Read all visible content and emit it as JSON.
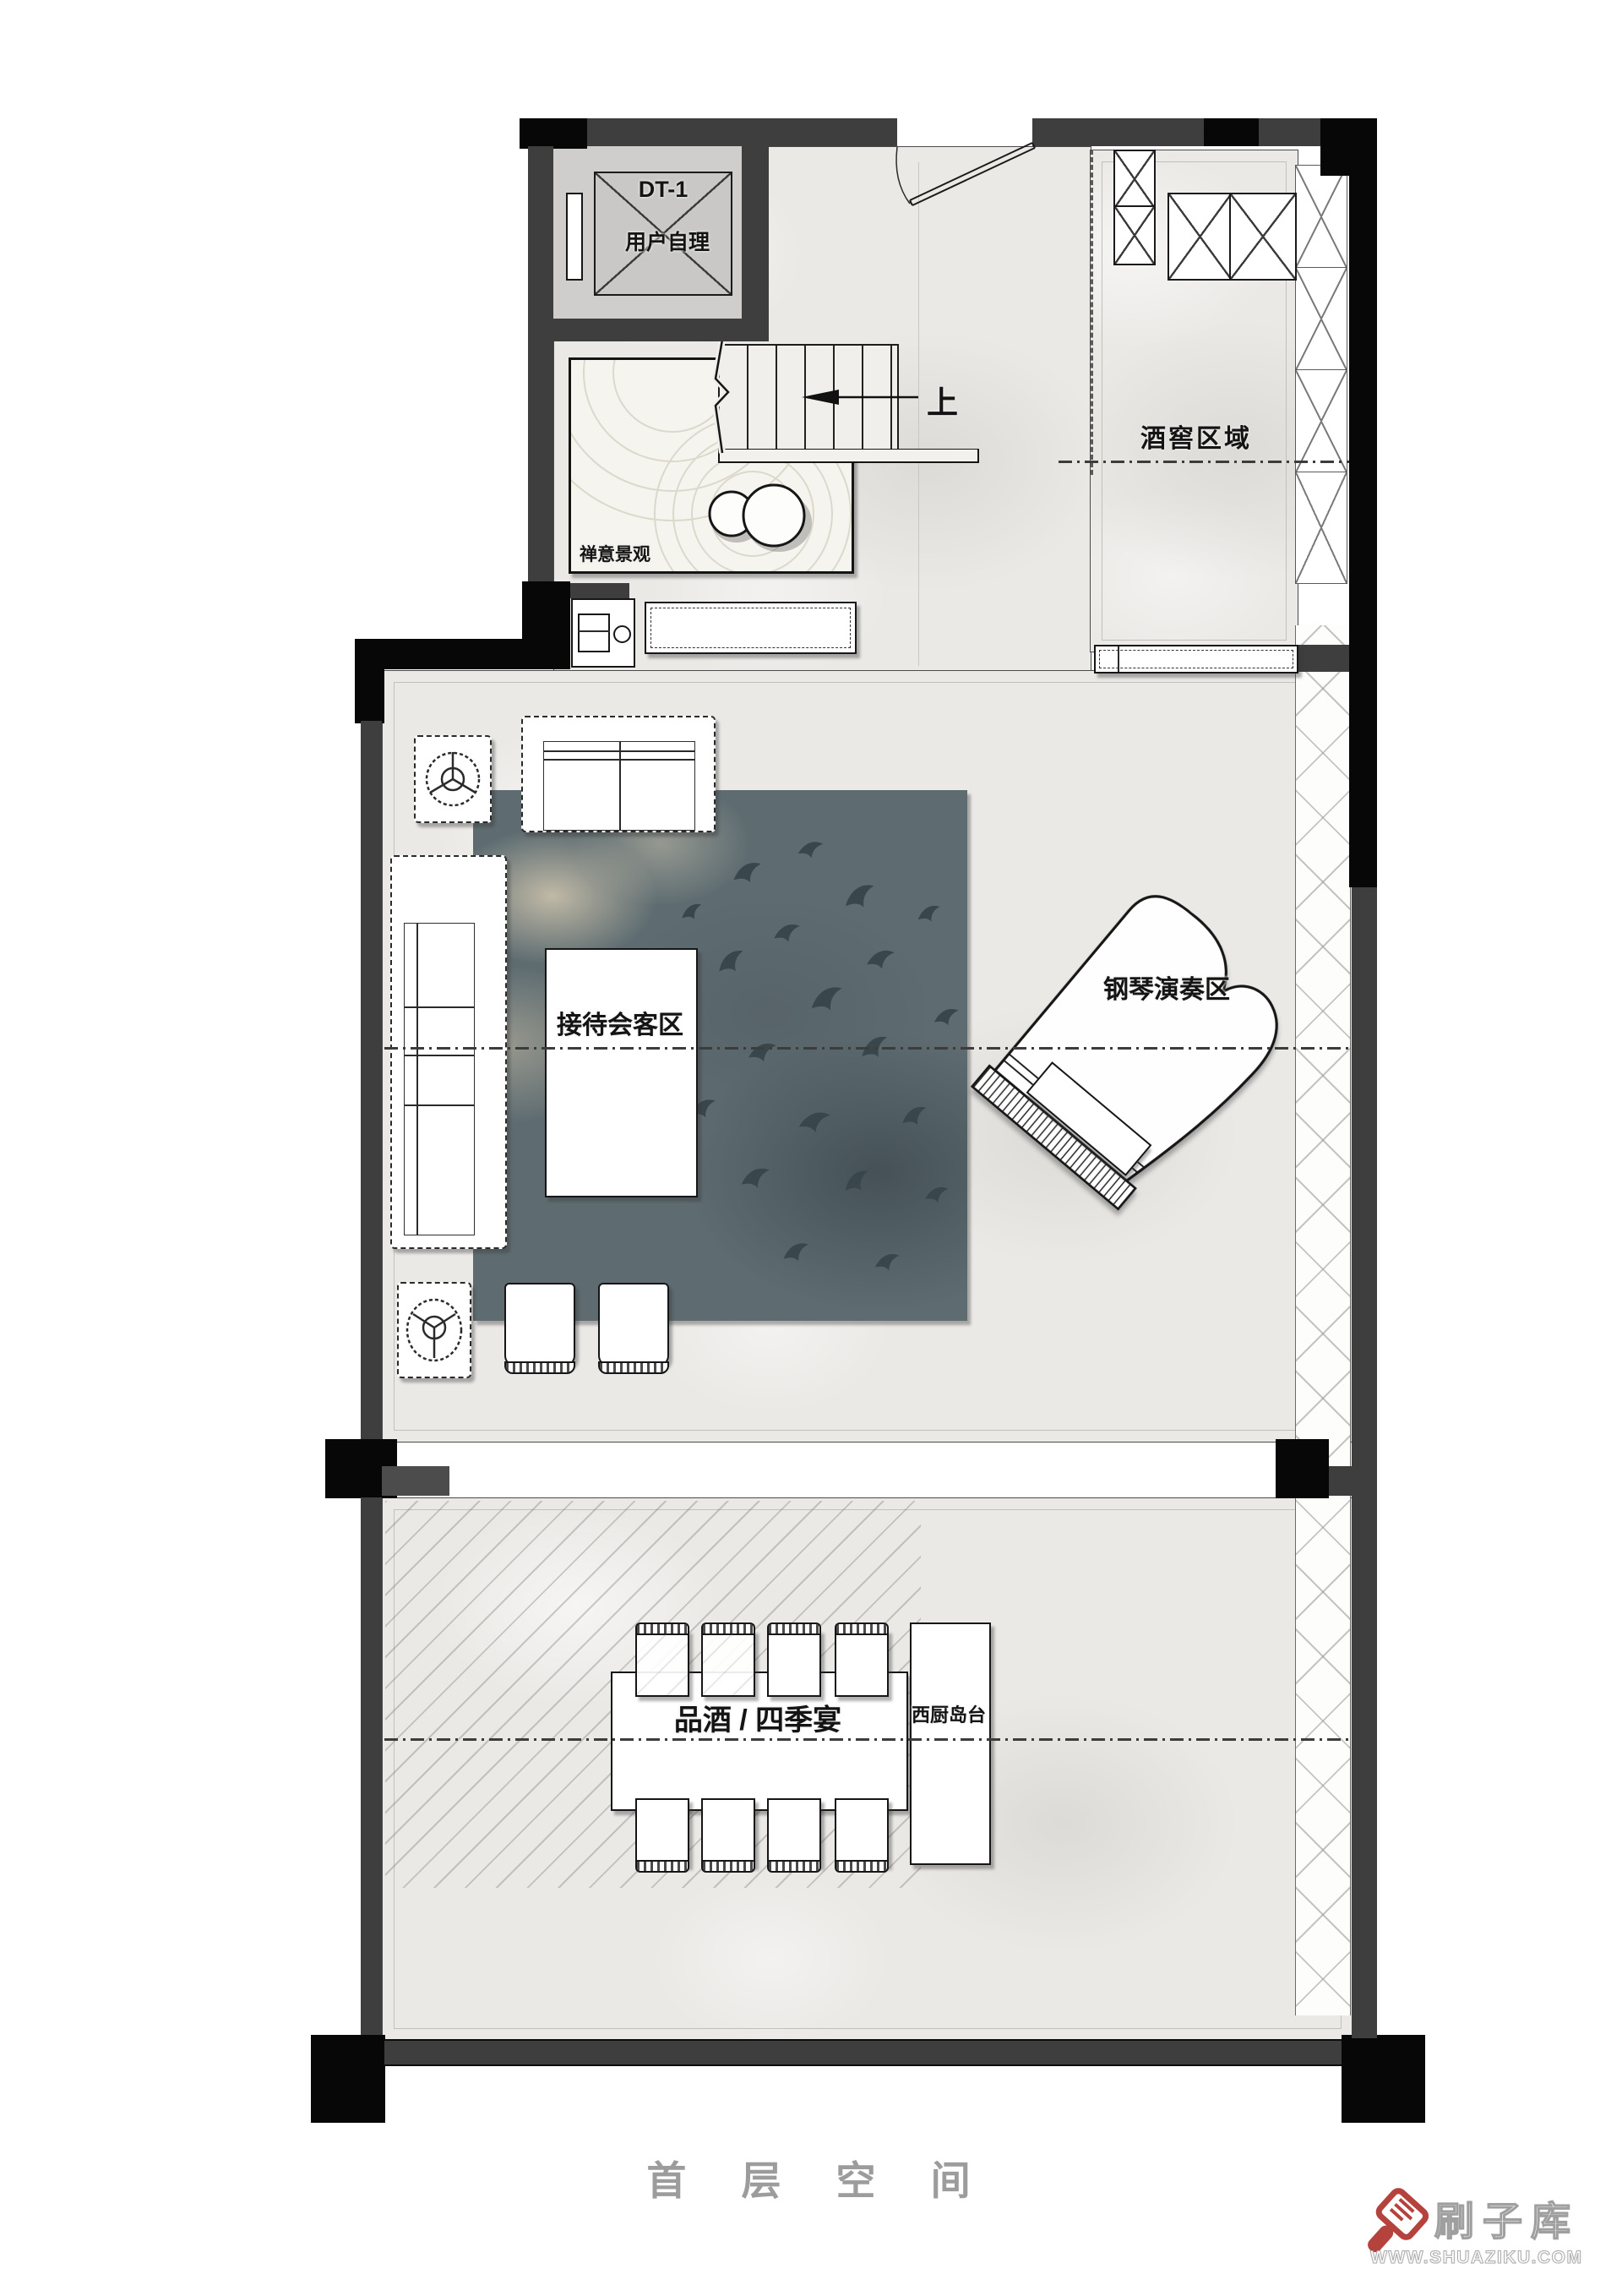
{
  "title": "首 层 空 间",
  "rooms": {
    "elevator": {
      "code": "DT-1",
      "note": "用户自理"
    },
    "stairs": {
      "up_label": "上"
    },
    "zen_garden": {
      "label": "禅意景观"
    },
    "wine_cellar": {
      "label": "酒窖区域"
    },
    "reception": {
      "label": "接待会客区"
    },
    "piano_area": {
      "label": "钢琴演奏区"
    },
    "dining": {
      "label": "品酒 / 四季宴"
    },
    "kitchen_island": {
      "label": "西厨岛台"
    }
  },
  "watermark": {
    "brand": "刷子库",
    "url": "WWW.SHUAZIKU.COM"
  },
  "colors": {
    "wall": "#3e3e3e",
    "column": "#070707",
    "floor": "#eae9e6",
    "rug": "#5e6c71",
    "title_gray": "#9c9c9c",
    "watermark_red": "#b5423d"
  }
}
